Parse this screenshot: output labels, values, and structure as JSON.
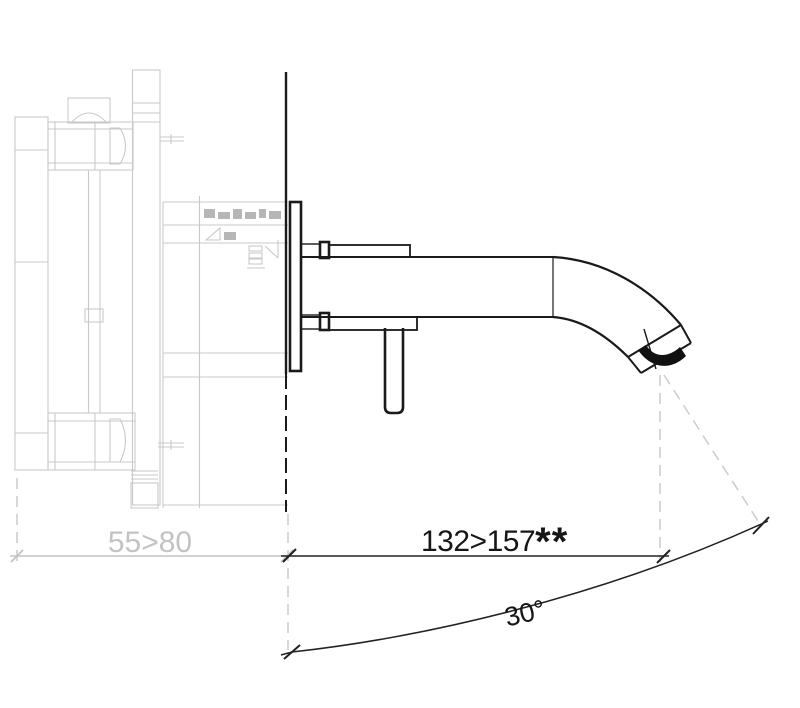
{
  "drawing": {
    "labels": {
      "projection_dim": "132>157",
      "projection_suffix": "**",
      "depth_dim": "55>80",
      "angle_dim": "30°"
    },
    "colors": {
      "ink": "#1a1a1a",
      "ghost": "#c9c9c9",
      "hatch": "#b6b6b6",
      "dim_gray": "#c3c3c3",
      "extension_gray": "#cccccc",
      "dim_black": "#222222"
    }
  }
}
